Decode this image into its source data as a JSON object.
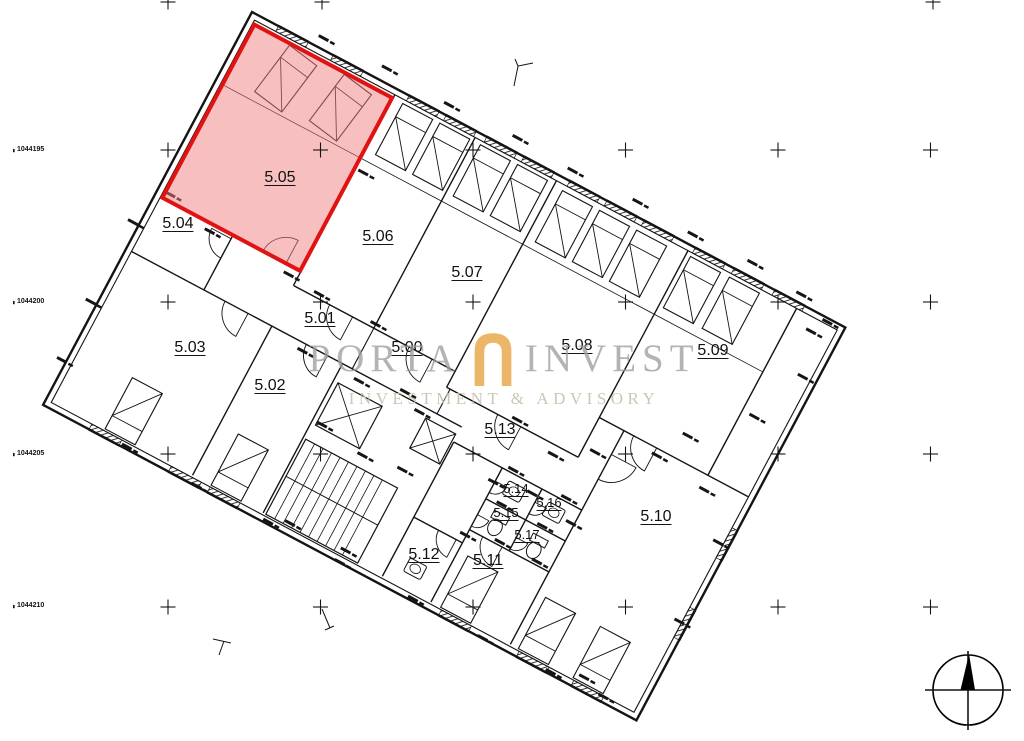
{
  "plan": {
    "type": "floor-plan",
    "floor_prefix": "5",
    "highlighted_room": "5.05"
  },
  "rooms": [
    {
      "id": "5.00"
    },
    {
      "id": "5.01"
    },
    {
      "id": "5.02"
    },
    {
      "id": "5.03"
    },
    {
      "id": "5.04"
    },
    {
      "id": "5.05",
      "highlighted": true
    },
    {
      "id": "5.06"
    },
    {
      "id": "5.07"
    },
    {
      "id": "5.08"
    },
    {
      "id": "5.09"
    },
    {
      "id": "5.10"
    },
    {
      "id": "5.11"
    },
    {
      "id": "5.12"
    },
    {
      "id": "5.13"
    },
    {
      "id": "5.14"
    },
    {
      "id": "5.15"
    },
    {
      "id": "5.16"
    },
    {
      "id": "5.17"
    }
  ],
  "coordinate_labels": [
    "1044195",
    "1044200",
    "1044205",
    "1044210"
  ],
  "highlight": {
    "fill": "#F08080",
    "fill_opacity": "0.5",
    "stroke": "#E01212"
  },
  "watermark": {
    "brand_first": "PORTA",
    "brand_second": "INVEST",
    "tagline": "INVESTMENT & ADVISORY",
    "brand_color": "#9E9E9E",
    "tagline_color": "#CCC3B2",
    "icon_color": "#EAAC54"
  },
  "compass": {
    "type": "north-arrow"
  },
  "line_color": "#141414"
}
